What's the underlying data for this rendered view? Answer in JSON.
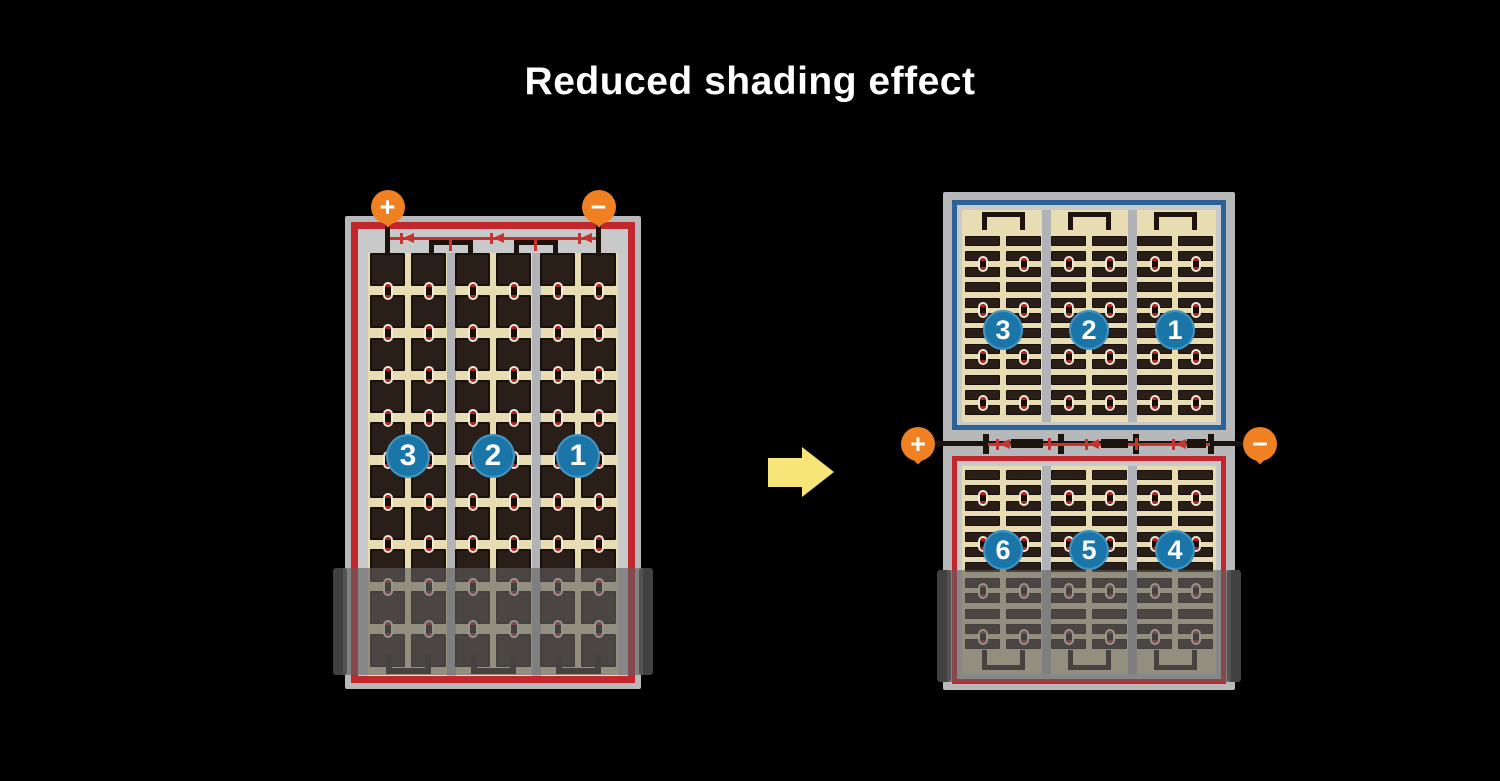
{
  "title": "Reduced shading effect",
  "colors": {
    "background": "#000000",
    "panel_frame_gray": "#b7b8ba",
    "panel_inner_gray": "#c8c9cb",
    "cell_field_tan": "#e7dcb2",
    "cell_dark": "#2a1f18",
    "cell_edge": "#19100b",
    "string_outline_red": "#c1272d",
    "string_outline_blue": "#2b6396",
    "diode_red": "#c5342f",
    "number_circle_blue": "#1a76a8",
    "number_circle_rim": "#4695c0",
    "terminal_orange": "#f08122",
    "arrow_yellow": "#f8e57a",
    "wire_black": "#1c130d",
    "separator_gray": "#b2b3b6",
    "connector_dot_red": "#b02424",
    "connector_dot_bg": "#f4ecd9",
    "shade_overlay": "rgba(95,95,95,0.62)",
    "shade_cap": "#414141"
  },
  "left_module": {
    "terminals": [
      {
        "sign": "+"
      },
      {
        "sign": "−"
      }
    ],
    "cell_strings": [
      {
        "label": "3"
      },
      {
        "label": "2"
      },
      {
        "label": "1"
      }
    ]
  },
  "right_module": {
    "terminals": [
      {
        "sign": "+"
      },
      {
        "sign": "−"
      }
    ],
    "top_half_strings": [
      {
        "label": "3"
      },
      {
        "label": "2"
      },
      {
        "label": "1"
      }
    ],
    "bottom_half_strings": [
      {
        "label": "6"
      },
      {
        "label": "5"
      },
      {
        "label": "4"
      }
    ]
  }
}
